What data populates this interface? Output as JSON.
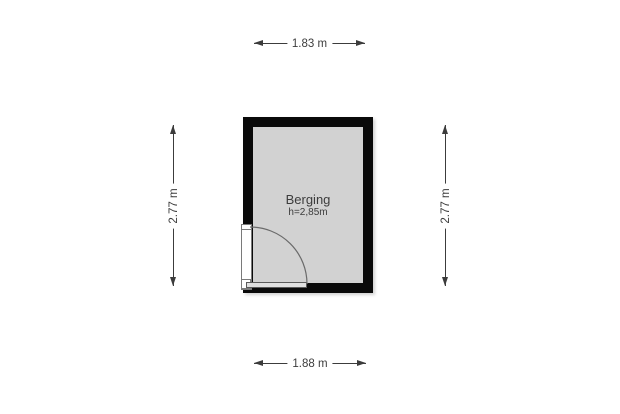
{
  "room": {
    "name": "Berging",
    "height_label": "h=2,85m"
  },
  "dimensions": {
    "top": "1.83 m",
    "bottom": "1.88 m",
    "left": "2.77 m",
    "right": "2.77 m"
  },
  "colors": {
    "wall": "#0a0a0a",
    "floor": "#d2d2d2",
    "dimension_text": "#3c3c3c",
    "door_arc": "#6a6a6a",
    "background": "#ffffff"
  }
}
